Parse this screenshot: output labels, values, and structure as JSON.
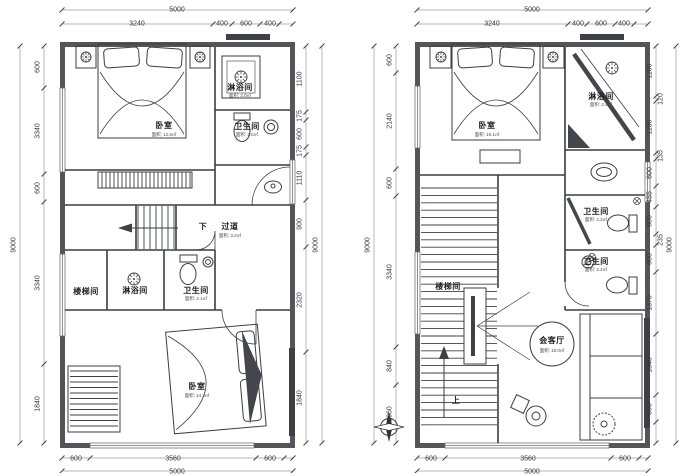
{
  "document": {
    "type": "architectural-floor-plans",
    "units": "mm",
    "colors": {
      "wall": "#54555b",
      "line": "#3c3d42",
      "dark_fill": "#3f4045",
      "dim_line": "#9a9ba0",
      "text": "#2f3033",
      "bg": "#ffffff"
    }
  },
  "plans": [
    {
      "name": "floor-plan-left",
      "overall": {
        "width_mm": "5000",
        "height_mm": "9000"
      },
      "labels": [
        {
          "text": "5000",
          "x": 177,
          "y": 10,
          "kind": "dim"
        },
        {
          "text": "3240",
          "x": 137,
          "y": 24,
          "kind": "dim"
        },
        {
          "text": "400",
          "x": 222,
          "y": 24,
          "kind": "dim"
        },
        {
          "text": "600",
          "x": 246,
          "y": 24,
          "kind": "dim"
        },
        {
          "text": "400",
          "x": 270,
          "y": 24,
          "kind": "dim"
        },
        {
          "text": "9000",
          "x": 14,
          "y": 245,
          "kind": "dim",
          "rot": true
        },
        {
          "text": "600",
          "x": 38,
          "y": 67,
          "kind": "dim",
          "rot": true
        },
        {
          "text": "3340",
          "x": 38,
          "y": 131,
          "kind": "dim",
          "rot": true
        },
        {
          "text": "600",
          "x": 38,
          "y": 188,
          "kind": "dim",
          "rot": true
        },
        {
          "text": "3340",
          "x": 38,
          "y": 283,
          "kind": "dim",
          "rot": true
        },
        {
          "text": "1840",
          "x": 38,
          "y": 404,
          "kind": "dim",
          "rot": true
        },
        {
          "text": "1100",
          "x": 300,
          "y": 79,
          "kind": "dim",
          "rot": true
        },
        {
          "text": "175",
          "x": 300,
          "y": 116,
          "kind": "dim",
          "rot": true
        },
        {
          "text": "600",
          "x": 300,
          "y": 134,
          "kind": "dim",
          "rot": true
        },
        {
          "text": "175",
          "x": 300,
          "y": 151,
          "kind": "dim",
          "rot": true
        },
        {
          "text": "1110",
          "x": 300,
          "y": 178,
          "kind": "dim",
          "rot": true
        },
        {
          "text": "900",
          "x": 300,
          "y": 224,
          "kind": "dim",
          "rot": true
        },
        {
          "text": "2320",
          "x": 300,
          "y": 300,
          "kind": "dim",
          "rot": true
        },
        {
          "text": "1840",
          "x": 300,
          "y": 398,
          "kind": "dim",
          "rot": true
        },
        {
          "text": "9000",
          "x": 316,
          "y": 245,
          "kind": "dim",
          "rot": true
        },
        {
          "text": "600",
          "x": 76,
          "y": 459,
          "kind": "dim"
        },
        {
          "text": "3560",
          "x": 173,
          "y": 459,
          "kind": "dim"
        },
        {
          "text": "600",
          "x": 270,
          "y": 459,
          "kind": "dim"
        },
        {
          "text": "5000",
          "x": 177,
          "y": 472,
          "kind": "dim"
        },
        {
          "text": "卧室",
          "x": 164,
          "y": 126,
          "kind": "room"
        },
        {
          "text": "面积: 12.6㎡",
          "x": 164,
          "y": 135,
          "kind": "area"
        },
        {
          "text": "淋浴间",
          "x": 240,
          "y": 88,
          "kind": "room"
        },
        {
          "text": "面积: 2.0㎡",
          "x": 240,
          "y": 96,
          "kind": "area"
        },
        {
          "text": "卫生间",
          "x": 247,
          "y": 127,
          "kind": "room"
        },
        {
          "text": "面积: 2.5㎡",
          "x": 247,
          "y": 135,
          "kind": "area"
        },
        {
          "text": "下",
          "x": 203,
          "y": 227,
          "kind": "room"
        },
        {
          "text": "过道",
          "x": 230,
          "y": 227,
          "kind": "room"
        },
        {
          "text": "面积: 3.2㎡",
          "x": 230,
          "y": 236,
          "kind": "area"
        },
        {
          "text": "楼梯间",
          "x": 86,
          "y": 292,
          "kind": "room"
        },
        {
          "text": "淋浴间",
          "x": 135,
          "y": 291,
          "kind": "room"
        },
        {
          "text": "卫生间",
          "x": 196,
          "y": 291,
          "kind": "room"
        },
        {
          "text": "面积: 2.1㎡",
          "x": 196,
          "y": 299,
          "kind": "area"
        },
        {
          "text": "卧室",
          "x": 197,
          "y": 387,
          "kind": "room"
        },
        {
          "text": "面积: 14.3㎡",
          "x": 197,
          "y": 396,
          "kind": "area"
        }
      ]
    },
    {
      "name": "floor-plan-right",
      "overall": {
        "width_mm": "5000",
        "height_mm": "9000"
      },
      "labels": [
        {
          "text": "5000",
          "x": 532,
          "y": 10,
          "kind": "dim"
        },
        {
          "text": "3240",
          "x": 492,
          "y": 24,
          "kind": "dim"
        },
        {
          "text": "400",
          "x": 578,
          "y": 24,
          "kind": "dim"
        },
        {
          "text": "600",
          "x": 601,
          "y": 24,
          "kind": "dim"
        },
        {
          "text": "400",
          "x": 624,
          "y": 24,
          "kind": "dim"
        },
        {
          "text": "9000",
          "x": 368,
          "y": 245,
          "kind": "dim",
          "rot": true
        },
        {
          "text": "600",
          "x": 390,
          "y": 60,
          "kind": "dim",
          "rot": true
        },
        {
          "text": "2140",
          "x": 390,
          "y": 121,
          "kind": "dim",
          "rot": true
        },
        {
          "text": "600",
          "x": 390,
          "y": 183,
          "kind": "dim",
          "rot": true
        },
        {
          "text": "3340",
          "x": 390,
          "y": 272,
          "kind": "dim",
          "rot": true
        },
        {
          "text": "840",
          "x": 390,
          "y": 366,
          "kind": "dim",
          "rot": true
        },
        {
          "text": "1060",
          "x": 390,
          "y": 414,
          "kind": "dim",
          "rot": true
        },
        {
          "text": "1100",
          "x": 650,
          "y": 71,
          "kind": "dim",
          "rot": true
        },
        {
          "text": "120",
          "x": 661,
          "y": 99,
          "kind": "dim",
          "rot": true
        },
        {
          "text": "1150",
          "x": 650,
          "y": 127,
          "kind": "dim",
          "rot": true
        },
        {
          "text": "135",
          "x": 661,
          "y": 156,
          "kind": "dim",
          "rot": true
        },
        {
          "text": "600",
          "x": 650,
          "y": 173,
          "kind": "dim",
          "rot": true
        },
        {
          "text": "455",
          "x": 650,
          "y": 197,
          "kind": "dim",
          "rot": true
        },
        {
          "text": "600",
          "x": 650,
          "y": 221,
          "kind": "dim",
          "rot": true
        },
        {
          "text": "235",
          "x": 661,
          "y": 240,
          "kind": "dim",
          "rot": true
        },
        {
          "text": "600",
          "x": 650,
          "y": 259,
          "kind": "dim",
          "rot": true
        },
        {
          "text": "1370",
          "x": 650,
          "y": 303,
          "kind": "dim",
          "rot": true
        },
        {
          "text": "1340",
          "x": 650,
          "y": 365,
          "kind": "dim",
          "rot": true
        },
        {
          "text": "600",
          "x": 650,
          "y": 409,
          "kind": "dim",
          "rot": true
        },
        {
          "text": "9000",
          "x": 670,
          "y": 245,
          "kind": "dim",
          "rot": true
        },
        {
          "text": "600",
          "x": 431,
          "y": 459,
          "kind": "dim"
        },
        {
          "text": "3560",
          "x": 528,
          "y": 459,
          "kind": "dim"
        },
        {
          "text": "600",
          "x": 625,
          "y": 459,
          "kind": "dim"
        },
        {
          "text": "5000",
          "x": 532,
          "y": 472,
          "kind": "dim"
        },
        {
          "text": "卧室",
          "x": 487,
          "y": 126,
          "kind": "room"
        },
        {
          "text": "面积: 16.1㎡",
          "x": 487,
          "y": 135,
          "kind": "area"
        },
        {
          "text": "淋浴间",
          "x": 601,
          "y": 97,
          "kind": "room"
        },
        {
          "text": "面积: 2.4㎡",
          "x": 601,
          "y": 105,
          "kind": "area"
        },
        {
          "text": "卫生间",
          "x": 596,
          "y": 212,
          "kind": "room"
        },
        {
          "text": "面积: 2.2㎡",
          "x": 596,
          "y": 220,
          "kind": "area"
        },
        {
          "text": "卫生间",
          "x": 596,
          "y": 262,
          "kind": "room"
        },
        {
          "text": "面积: 2.2㎡",
          "x": 596,
          "y": 270,
          "kind": "area"
        },
        {
          "text": "楼梯间",
          "x": 448,
          "y": 287,
          "kind": "room"
        },
        {
          "text": "上",
          "x": 456,
          "y": 401,
          "kind": "room"
        },
        {
          "text": "会客厅",
          "x": 552,
          "y": 341,
          "kind": "room"
        },
        {
          "text": "面积: 19.0㎡",
          "x": 552,
          "y": 351,
          "kind": "area"
        }
      ]
    }
  ]
}
